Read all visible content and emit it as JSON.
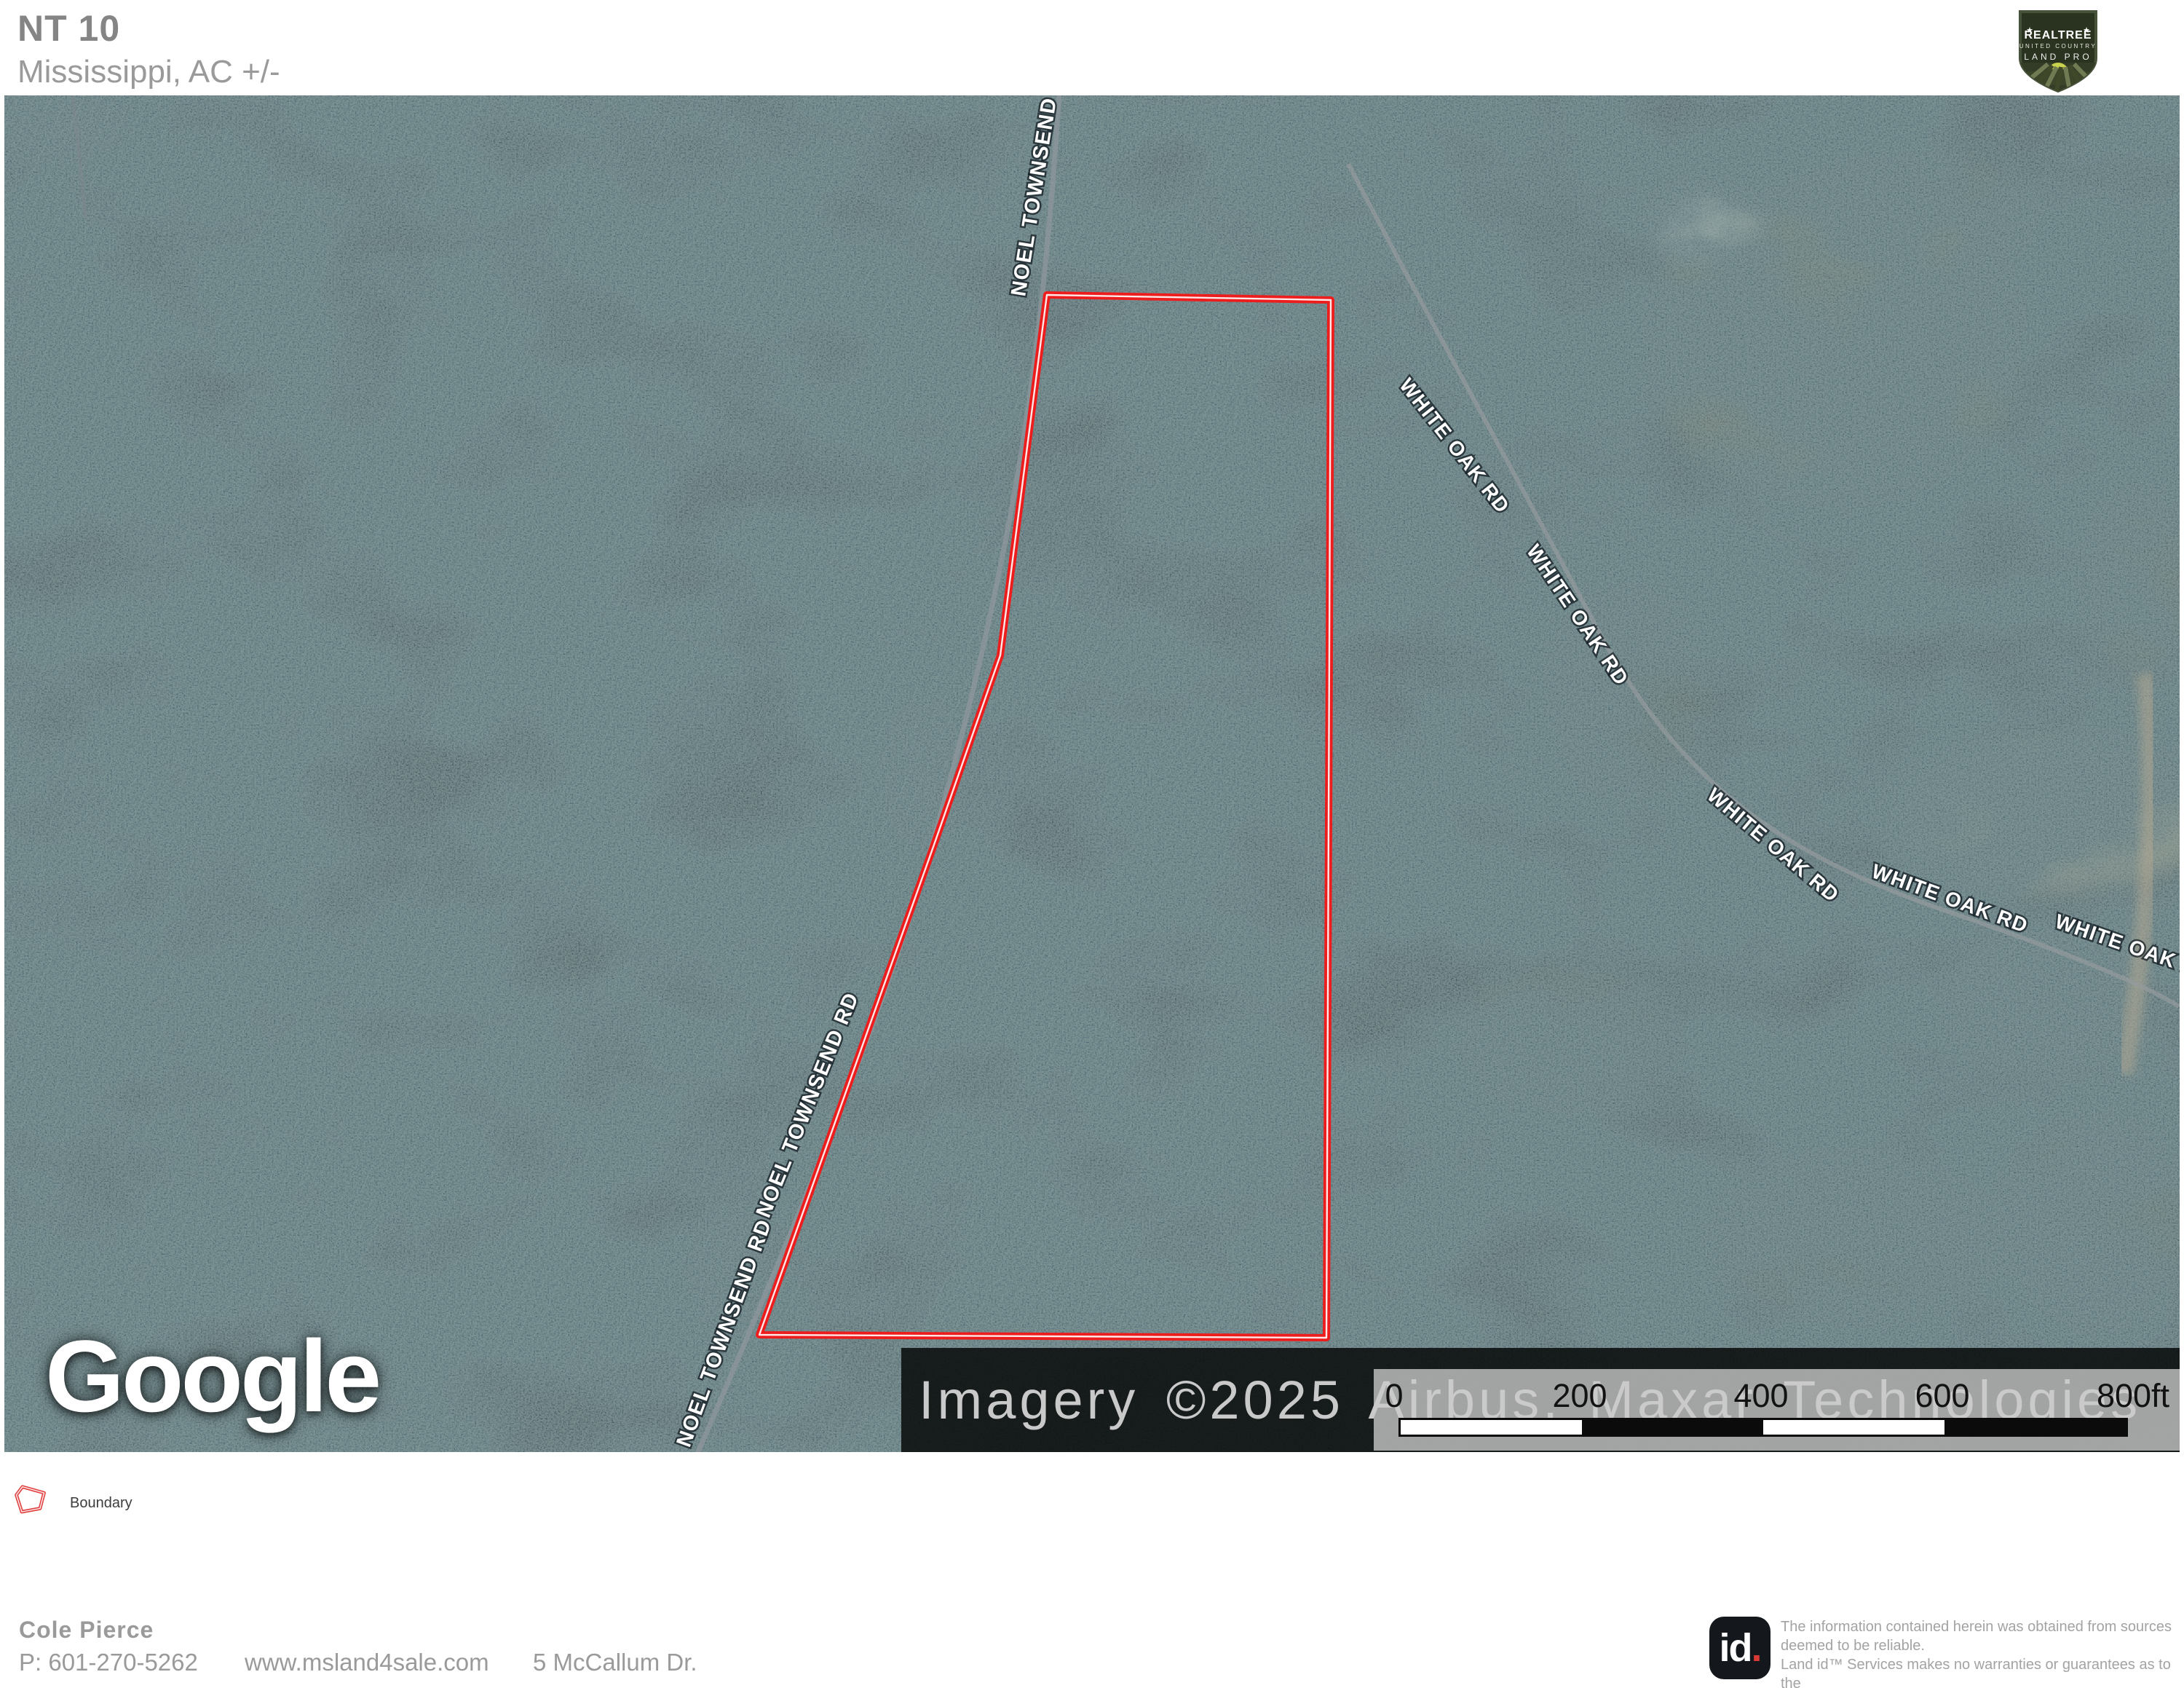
{
  "header": {
    "title": "NT 10",
    "subtitle": "Mississippi,  AC +/-"
  },
  "brand": {
    "line1": "REALTREE",
    "line2": "UNITED COUNTRY",
    "line3": "LAND PRO",
    "star": "★"
  },
  "map": {
    "google_logo": "Google",
    "attribution": "Imagery ©2025 Airbus, Maxar Technologies",
    "road_labels": [
      {
        "road": "noel-townsend-rd",
        "text": "NOEL TOWNSEND RD"
      },
      {
        "road": "noel-townsend-rd",
        "text": "NOEL TOWNSEND RD"
      },
      {
        "road": "noel-townsend-rd",
        "text": "NOEL TOWNSEND RD"
      },
      {
        "road": "white-oak-rd",
        "text": "WHITE OAK RD"
      },
      {
        "road": "white-oak-rd",
        "text": "WHITE OAK RD"
      },
      {
        "road": "white-oak-rd",
        "text": "WHITE OAK RD"
      },
      {
        "road": "white-oak-rd",
        "text": "WHITE OAK RD"
      },
      {
        "road": "white-oak-rd",
        "text": "WHITE OAK RD"
      }
    ],
    "scalebar": {
      "labels": [
        "0",
        "200",
        "400",
        "600",
        "800ft"
      ]
    }
  },
  "legend": {
    "boundary_label": "Boundary"
  },
  "footer": {
    "agent_name": "Cole  Pierce",
    "phone": "P: 601-270-5262",
    "website": "www.msland4sale.com",
    "address": "5 McCallum Dr.",
    "id_logo": {
      "text": "id",
      "dot": "."
    },
    "disclaimer_lines": [
      "The information contained herein was obtained from sources",
      "deemed to be reliable.",
      " Land id™ Services makes no warranties or guarantees as to the",
      "completeness or accuracy thereof."
    ]
  },
  "colors": {
    "boundary_red": "#ee1d1d",
    "id_dot_red": "#d93a35"
  }
}
